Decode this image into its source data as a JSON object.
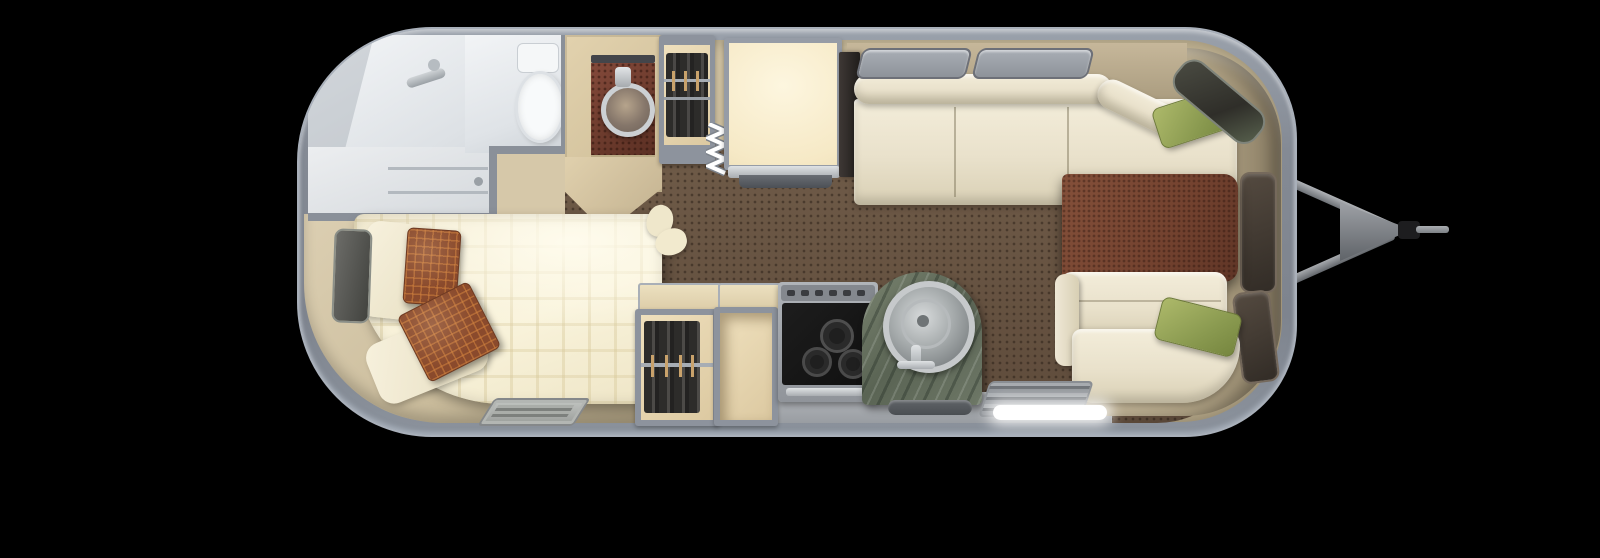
{
  "meta": {
    "description": "Top-down floor plan rendering of a travel trailer with hitch on the right",
    "background_color": "#000000"
  },
  "palette": {
    "shell_wall": "#878d97",
    "shell_edge": "#aab1bb",
    "carpet_brown": "#64513f",
    "platform_tan": "#d7c9a9",
    "ledge_tan": "#b7a98a",
    "bath_white": "#eef0f2",
    "bed_cream": "#f6efd7",
    "pillow_rust": "#8a4a2c",
    "pillow_cream": "#f4eed8",
    "sofa_cream": "#ece5d2",
    "pillow_green": "#9aa85e",
    "table_brown": "#7b4a34",
    "window_dark": "#3f3a36",
    "door_cream": "#f8eccd",
    "clothes_dark": "#2b2a29",
    "counter_marble": "#68725f",
    "stove_black": "#171717",
    "vanity_tile": "#7c4433",
    "chrome": "#c2c5c8",
    "step_light": "#ffffff"
  },
  "regions": {
    "stage": "trailer floor plan",
    "shell": "trailer shell",
    "hitch": "tow hitch",
    "shower": "shower",
    "toilet_room": "toilet room",
    "toilet": "toilet",
    "bath_drawers": "bathroom drawers",
    "vanity": "bathroom vanity sink",
    "wardrobe_upper": "wardrobe closet",
    "screen_door": "folding screen door",
    "entry_door": "entry door",
    "media_cabinet": "media cabinet",
    "sofa": "front sofa",
    "table": "coffee table",
    "bench": "front bench seat",
    "bed": "bed with plaid bedding",
    "wardrobe_lower": "wardrobe closet",
    "empty_cabinet": "storage cabinet",
    "stove": "three burner cooktop",
    "kitchen_sink": "round kitchen sink on marble counter",
    "window": "window",
    "floor_vent": "floor vent",
    "step_grate": "step grate",
    "step_light": "illuminated entry step",
    "pillow_green": "green accent pillow",
    "pillow_rust": "rust patterned pillow",
    "ledge": "wraparound front ledge"
  },
  "counts": {
    "stove_burners": 3,
    "green_pillows": 2,
    "rust_pillows": 2,
    "cream_pillows": 2,
    "top_windows": 2,
    "front_windows": 3,
    "bedroom_windows": 1
  }
}
